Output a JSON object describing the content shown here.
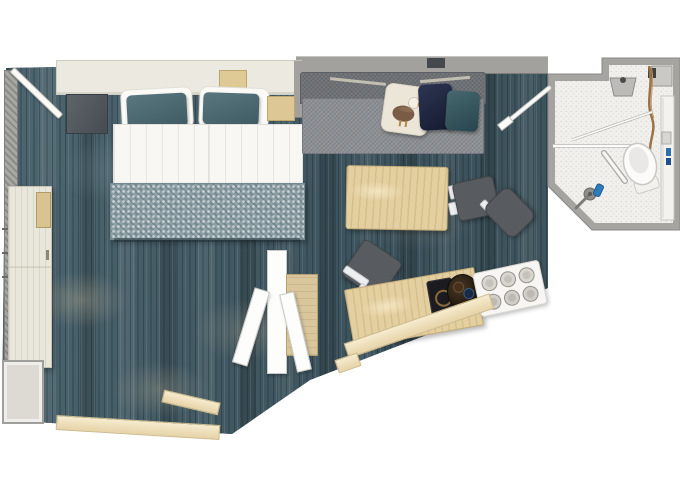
{
  "scene": {
    "type": "floor-plan",
    "subject": "cabin-stateroom-top-down-plan",
    "background_color": "#ffffff",
    "text_content": []
  },
  "palette": {
    "floor_teal": "#445a63",
    "floor_streak_beige": "#c1b296",
    "wall_gray": "#a2a19e",
    "wood_birch": "#e3cf9f",
    "closet_cream": "#e9e6db",
    "sill_cream": "#eedfb8",
    "bedding_white": "#f8f7f3",
    "pillow_teal": "#4a666e",
    "pillow_navy": "#232c48",
    "pillow_bird_cream": "#ece6d8",
    "sofa_gray": "#8d9094",
    "chair_dark_gray": "#585c60",
    "bathroom_floor_white": "#f1f0ec",
    "fixture_white": "#fbfaf8",
    "accent_blue": "#2f7cba",
    "towel_brown": "#9a7248",
    "blanket_teal": "#8da0a6"
  },
  "rooms": {
    "bedroom": {
      "furniture": [
        "entrance-door",
        "entry-cabinet",
        "wardrobe",
        "safe",
        "dresser",
        "double-bed",
        "headboard",
        "nightstand",
        "white-pillows",
        "teal-pillows",
        "duvets",
        "foot-blanket",
        "window-sills"
      ]
    },
    "living_area": {
      "furniture": [
        "sofa",
        "bird-pillow",
        "navy-pillow",
        "teal-pillow",
        "coffee-table",
        "dining-chair-1",
        "dining-chair-2",
        "desk",
        "desk-chair",
        "tablet",
        "minibar-tray",
        "glass-tray",
        "tv-divider",
        "divider-cabinet",
        "window-sill"
      ]
    },
    "bathroom": {
      "furniture": [
        "bathroom-door",
        "sink",
        "faucet",
        "cistern-unit",
        "vanity-counter",
        "toiletries",
        "tissue-box",
        "towel-rail",
        "toilet",
        "shower-partition",
        "shower-rail",
        "grab-bar",
        "shower-mixer",
        "shampoo-bottle"
      ]
    }
  },
  "counts": {
    "beds": 2,
    "teal-bed-pillows": 2,
    "sofa-pillows": 3,
    "dining-chairs": 2,
    "glasses-on-tray": 6
  }
}
